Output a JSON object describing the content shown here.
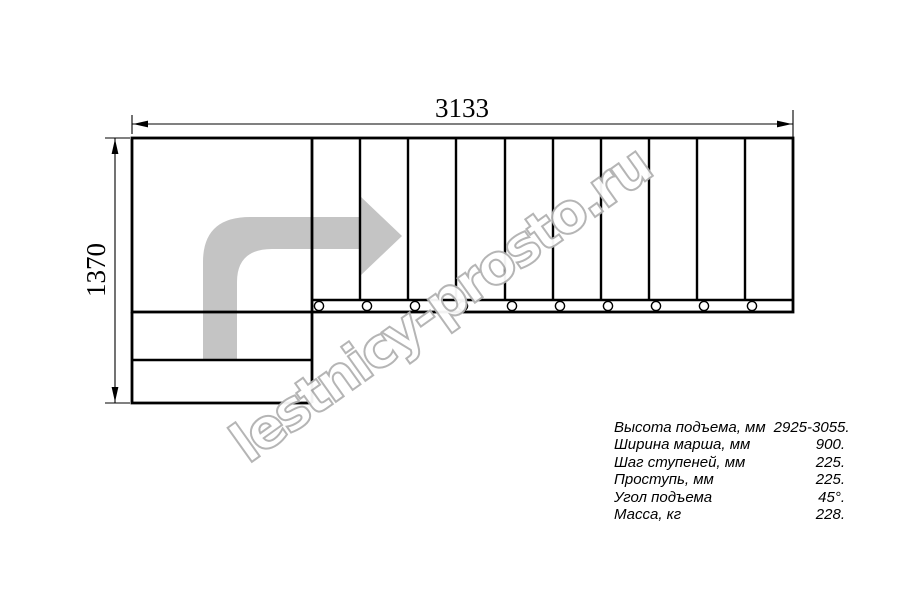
{
  "drawing": {
    "width_dimension": "3133",
    "height_dimension": "1370",
    "watermark": "lestnicy-prosto.ru",
    "tread_count": 10
  },
  "specs": {
    "rows": [
      {
        "label": "Высота подъема, мм",
        "value": "2925-3055."
      },
      {
        "label": "Ширина марша, мм",
        "value": "900."
      },
      {
        "label": "Шаг ступеней, мм",
        "value": "225."
      },
      {
        "label": "Проступь, мм",
        "value": "225."
      },
      {
        "label": "Угол подъема",
        "value": "45°."
      },
      {
        "label": "Масса, кг",
        "value": "228."
      }
    ]
  },
  "colors": {
    "line": "#000000",
    "arrow_fill": "#c4c4c4",
    "watermark_outline": "#b2b2b2",
    "background": "#ffffff"
  }
}
